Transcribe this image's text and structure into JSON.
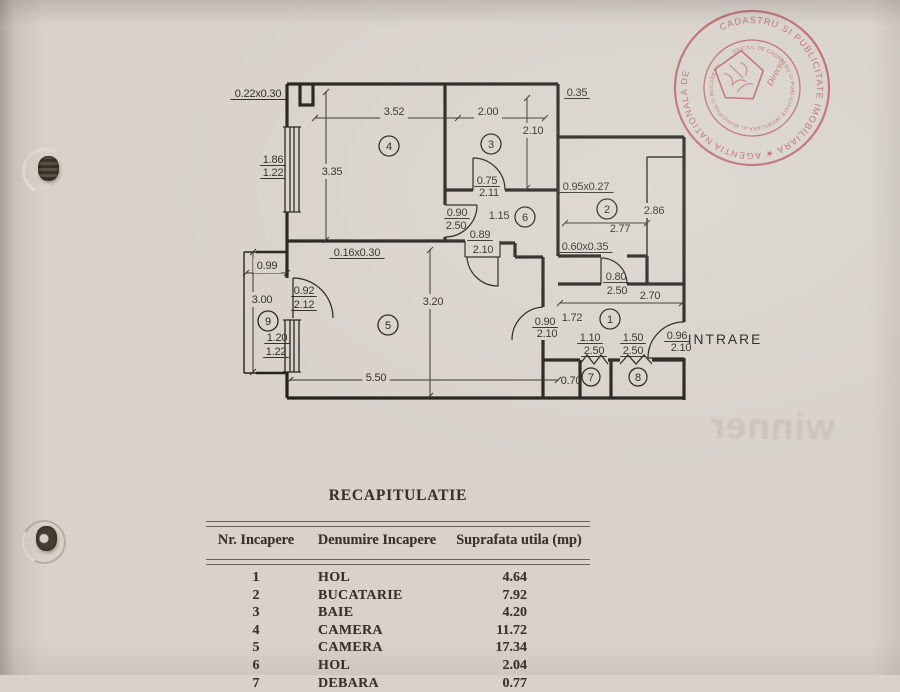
{
  "paper": {
    "bg": "#d8d2cb",
    "ink": "#23221c",
    "stamp_color": "#b9565a"
  },
  "watermark": {
    "text": "winner"
  },
  "stamp": {
    "outer_text": "CADASTRU SI PUBLICITATE IMOBILIARA ★ AGENTIA NATIONALA DE ",
    "inner_text": "OFICIUL DE CADASTRU SI PUBLICITATE IMOBILIARA AL MUNICIPIULUI BUCURESTI",
    "center_text": "Director"
  },
  "plan": {
    "entrance_label": "INTRARE",
    "rooms": [
      {
        "n": "1",
        "x": 610,
        "y": 319
      },
      {
        "n": "2",
        "x": 607,
        "y": 209
      },
      {
        "n": "3",
        "x": 491,
        "y": 144
      },
      {
        "n": "4",
        "x": 389,
        "y": 146
      },
      {
        "n": "5",
        "x": 388,
        "y": 325
      },
      {
        "n": "6",
        "x": 525,
        "y": 217
      },
      {
        "n": "7",
        "x": 591,
        "y": 377,
        "r": 9
      },
      {
        "n": "8",
        "x": 638,
        "y": 377,
        "r": 9
      },
      {
        "n": "9",
        "x": 268,
        "y": 321
      }
    ],
    "dims": [
      {
        "t": "0.22x0.30",
        "x": 258,
        "y": 97,
        "ul": 1
      },
      {
        "t": "3.52",
        "x": 394,
        "y": 115,
        "mask": 1
      },
      {
        "t": "2.00",
        "x": 488,
        "y": 115,
        "mask": 1
      },
      {
        "t": "0.35",
        "x": 577,
        "y": 96,
        "ul": 1
      },
      {
        "t": "2.10",
        "x": 533,
        "y": 134,
        "mask": 1
      },
      {
        "t": "1.86",
        "x": 273,
        "y": 163,
        "ul": 1
      },
      {
        "t": "1.22",
        "x": 273,
        "y": 176,
        "ul": 1
      },
      {
        "t": "3.35",
        "x": 332,
        "y": 175,
        "mask": 1
      },
      {
        "t": "0.75",
        "x": 487,
        "y": 184,
        "ul": 1
      },
      {
        "t": "2.11",
        "x": 489,
        "y": 196
      },
      {
        "t": "0.95x0.27",
        "x": 586,
        "y": 190,
        "ul": 1
      },
      {
        "t": "2.86",
        "x": 654,
        "y": 214,
        "mask": 1
      },
      {
        "t": "2.77",
        "x": 620,
        "y": 232
      },
      {
        "t": "0.90",
        "x": 457,
        "y": 216,
        "ul": 1
      },
      {
        "t": "2.50",
        "x": 456,
        "y": 229
      },
      {
        "t": "1.15",
        "x": 499,
        "y": 219
      },
      {
        "t": "0.89",
        "x": 480,
        "y": 238,
        "ul": 1
      },
      {
        "t": "2.10",
        "x": 483,
        "y": 253
      },
      {
        "t": "0.60x0.35",
        "x": 585,
        "y": 250,
        "ul": 1
      },
      {
        "t": "0.16x0.30",
        "x": 357,
        "y": 256,
        "ul": 1
      },
      {
        "t": "0.99",
        "x": 267,
        "y": 269,
        "mask": 1
      },
      {
        "t": "0.80",
        "x": 616,
        "y": 280,
        "ul": 1
      },
      {
        "t": "2.50",
        "x": 617,
        "y": 294
      },
      {
        "t": "2.70",
        "x": 650,
        "y": 299
      },
      {
        "t": "3.00",
        "x": 262,
        "y": 303,
        "mask": 1
      },
      {
        "t": "0.92",
        "x": 304,
        "y": 294,
        "ul": 1
      },
      {
        "t": "2.12",
        "x": 304,
        "y": 308,
        "ul": 1
      },
      {
        "t": "3.20",
        "x": 433,
        "y": 305,
        "mask": 1
      },
      {
        "t": "0.90",
        "x": 545,
        "y": 325,
        "ul": 1
      },
      {
        "t": "2.10",
        "x": 547,
        "y": 337
      },
      {
        "t": "1.72",
        "x": 572,
        "y": 321
      },
      {
        "t": "0.96",
        "x": 677,
        "y": 339,
        "ul": 1
      },
      {
        "t": "2.10",
        "x": 681,
        "y": 351
      },
      {
        "t": "1.10",
        "x": 590,
        "y": 341,
        "ul": 1
      },
      {
        "t": "2.50",
        "x": 594,
        "y": 354,
        "ul": 1
      },
      {
        "t": "1.50",
        "x": 633,
        "y": 341,
        "ul": 1
      },
      {
        "t": "2.50",
        "x": 633,
        "y": 354,
        "ul": 1
      },
      {
        "t": "1.20",
        "x": 277,
        "y": 341,
        "ul": 1
      },
      {
        "t": "1.22",
        "x": 276,
        "y": 355,
        "ul": 1
      },
      {
        "t": "5.50",
        "x": 376,
        "y": 381,
        "mask": 1
      },
      {
        "t": "0.70",
        "x": 571,
        "y": 384
      },
      {
        "t": "INTRARE",
        "x": 725,
        "y": 344,
        "cls": "big"
      }
    ]
  },
  "table": {
    "title": "RECAPITULATIE",
    "headers": [
      "Nr. Incapere",
      "Denumire Incapere",
      "Suprafata utila (mp)"
    ],
    "rows": [
      [
        "1",
        "HOL",
        "4.64"
      ],
      [
        "2",
        "BUCATARIE",
        "7.92"
      ],
      [
        "3",
        "BAIE",
        "4.20"
      ],
      [
        "4",
        "CAMERA",
        "11.72"
      ],
      [
        "5",
        "CAMERA",
        "17.34"
      ],
      [
        "6",
        "HOL",
        "2.04"
      ],
      [
        "7",
        "DEBARA",
        "0.77"
      ]
    ]
  }
}
